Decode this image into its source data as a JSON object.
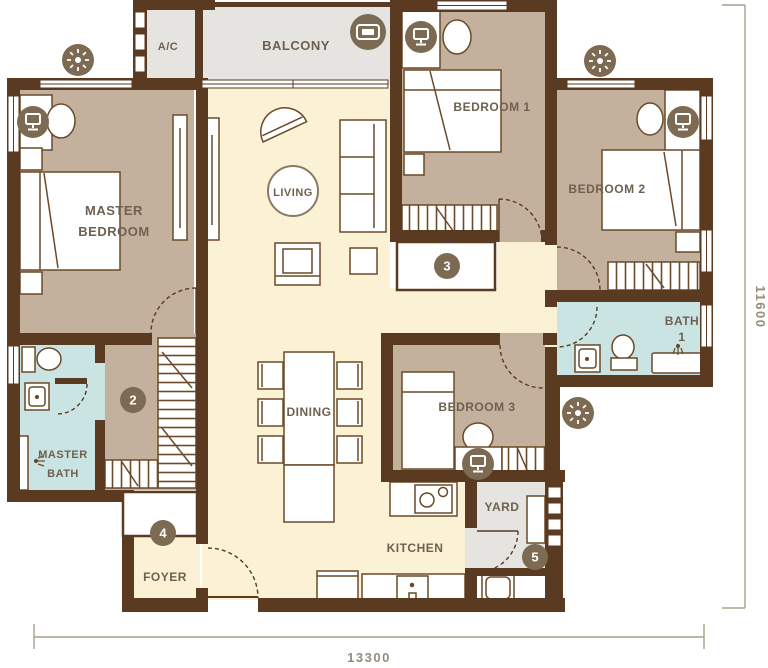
{
  "plan": {
    "rooms": {
      "balcony": "BALCONY",
      "ac": "A/C",
      "living": "LIVING",
      "master_bedroom_line1": "MASTER",
      "master_bedroom_line2": "BEDROOM",
      "bedroom1": "BEDROOM 1",
      "bedroom2": "BEDROOM 2",
      "bedroom3": "BEDROOM 3",
      "bath1_line1": "BATH",
      "bath1_line2": "1",
      "master_bath_line1": "MASTER",
      "master_bath_line2": "BATH",
      "dining": "DINING",
      "kitchen": "KITCHEN",
      "foyer": "FOYER",
      "yard": "YARD"
    },
    "markers": {
      "m2": "2",
      "m3": "3",
      "m4": "4",
      "m5": "5"
    },
    "dimensions": {
      "bottom": "13300",
      "right": "11600"
    },
    "icons": {
      "light": "ceiling-light-icon",
      "monitor": "monitor-icon",
      "bench": "balcony-bench-icon",
      "shower": "shower-head-icon"
    },
    "colors": {
      "wall": "#5a3a21",
      "floor_living": "#fbf1d5",
      "floor_bedroom": "#c3b19d",
      "floor_bath": "#c9e4e2",
      "floor_service": "#e5e4e1",
      "icon_circle": "#7c6b52",
      "label_text": "#6f6150",
      "dimension_text": "#968d7a"
    }
  }
}
